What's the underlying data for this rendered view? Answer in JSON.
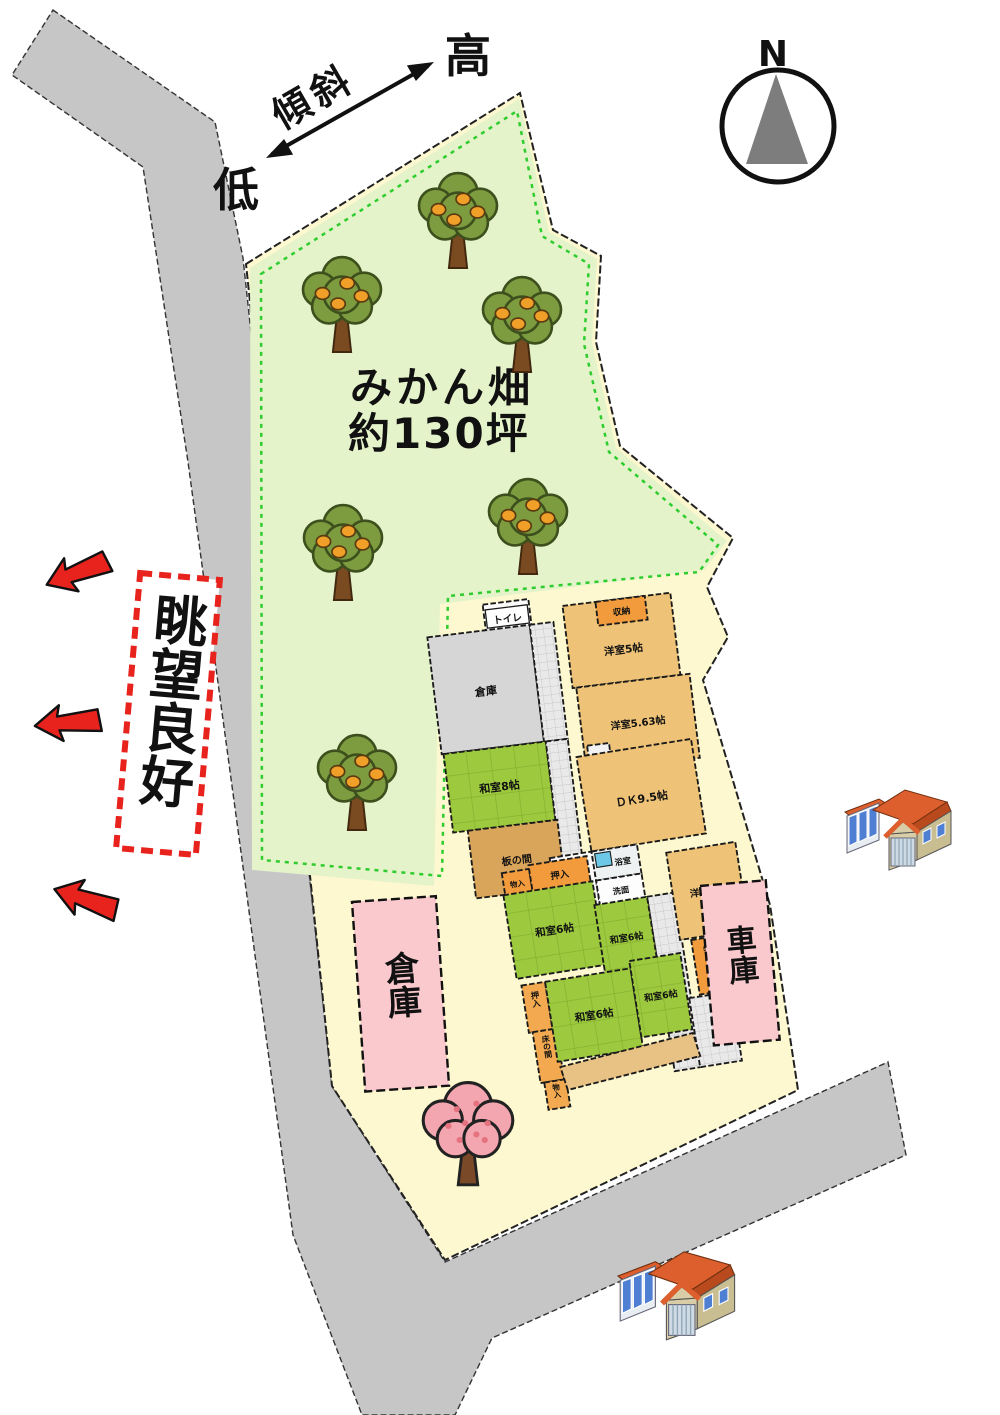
{
  "compass": {
    "north": "N"
  },
  "slope": {
    "label": "傾斜",
    "high": "高",
    "low": "低"
  },
  "view": {
    "label": "眺望良好"
  },
  "orchard": {
    "name": "みかん畑",
    "area": "約130坪"
  },
  "sheds": {
    "warehouse": "倉庫",
    "garage": "車庫"
  },
  "rooms": {
    "toilet": "トイレ",
    "storeroom": "倉庫",
    "shunou": "収納",
    "western_5": "洋室5帖",
    "western_5_63": "洋室5.63帖",
    "japanese_8": "和室8帖",
    "itanoma": "板の間",
    "dk": "ＤＫ9.5帖",
    "bath": "浴室",
    "washstand": "洗面",
    "monoire_top": "物入",
    "oshiire_top": "押入",
    "japanese_6_a": "和室6帖",
    "japanese_6_b": "和室6帖",
    "western_4": "洋室4帖",
    "monoire_right": "物入",
    "oshiire_left": "押入",
    "tokonoma": "床の間",
    "monoire_bottom": "物入",
    "japanese_6_c": "和室6帖",
    "japanese_6_d": "和室6帖"
  },
  "colors": {
    "road": "#c6c6c6",
    "parcel": "#fdf8cf",
    "orchard": "#e4f3c9",
    "orchard_dash": "#2ecc2e",
    "tatami": "#9cc93e",
    "wood_room": "#efc377",
    "closet": "#f29b3c",
    "itanoma": "#d9a55a",
    "shed_pink": "#f9c9ce",
    "accent_red": "#e8231e",
    "tree_green": "#7d9c40",
    "fruit_orange": "#f0a028",
    "cherry_pink": "#f4a6b0"
  }
}
